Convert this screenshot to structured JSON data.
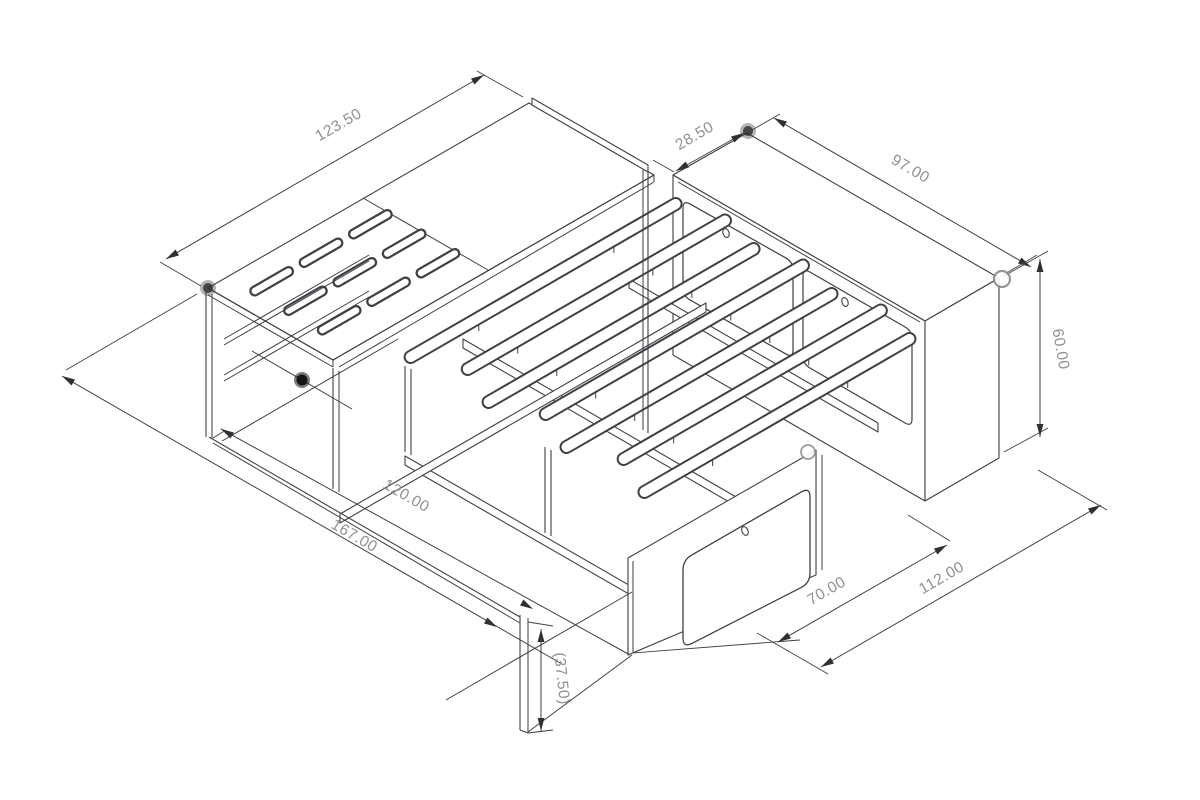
{
  "drawing": {
    "kind": "isometric CAD line drawing",
    "subject": "bed frame with slatted deck, slotted platform and drawer bench",
    "background": "#ffffff",
    "line_color": "#3f3f46",
    "dim_text_color": "#8f8f96",
    "marker_fill_color": "#2b2b2b",
    "marker_open_stroke": "#8a8a8a"
  },
  "dimensions": [
    {
      "id": "platform-length",
      "label": "123.50",
      "orientation": "iso-left-axis"
    },
    {
      "id": "bench-depth",
      "label": "28.50",
      "orientation": "iso-left-axis"
    },
    {
      "id": "bench-length",
      "label": "97.00",
      "orientation": "iso-right-axis"
    },
    {
      "id": "bench-height",
      "label": "60.00",
      "orientation": "vertical"
    },
    {
      "id": "frame-length",
      "label": "112.00",
      "orientation": "iso-left-axis"
    },
    {
      "id": "opening-width",
      "label": "70.00",
      "orientation": "iso-left-axis"
    },
    {
      "id": "bed-width",
      "label": "120.00",
      "orientation": "iso-right-axis"
    },
    {
      "id": "overall-width",
      "label": "167.00",
      "orientation": "iso-right-axis"
    },
    {
      "id": "support-height",
      "label": "(37.50)",
      "orientation": "vertical"
    }
  ],
  "markers": [
    {
      "id": "vertex-platform-corner",
      "type": "filled"
    },
    {
      "id": "vertex-bench-corner",
      "type": "filled"
    },
    {
      "id": "vertex-frame-left",
      "type": "filled"
    },
    {
      "id": "vertex-bench-right",
      "type": "open"
    },
    {
      "id": "vertex-rail-mid",
      "type": "open"
    }
  ]
}
